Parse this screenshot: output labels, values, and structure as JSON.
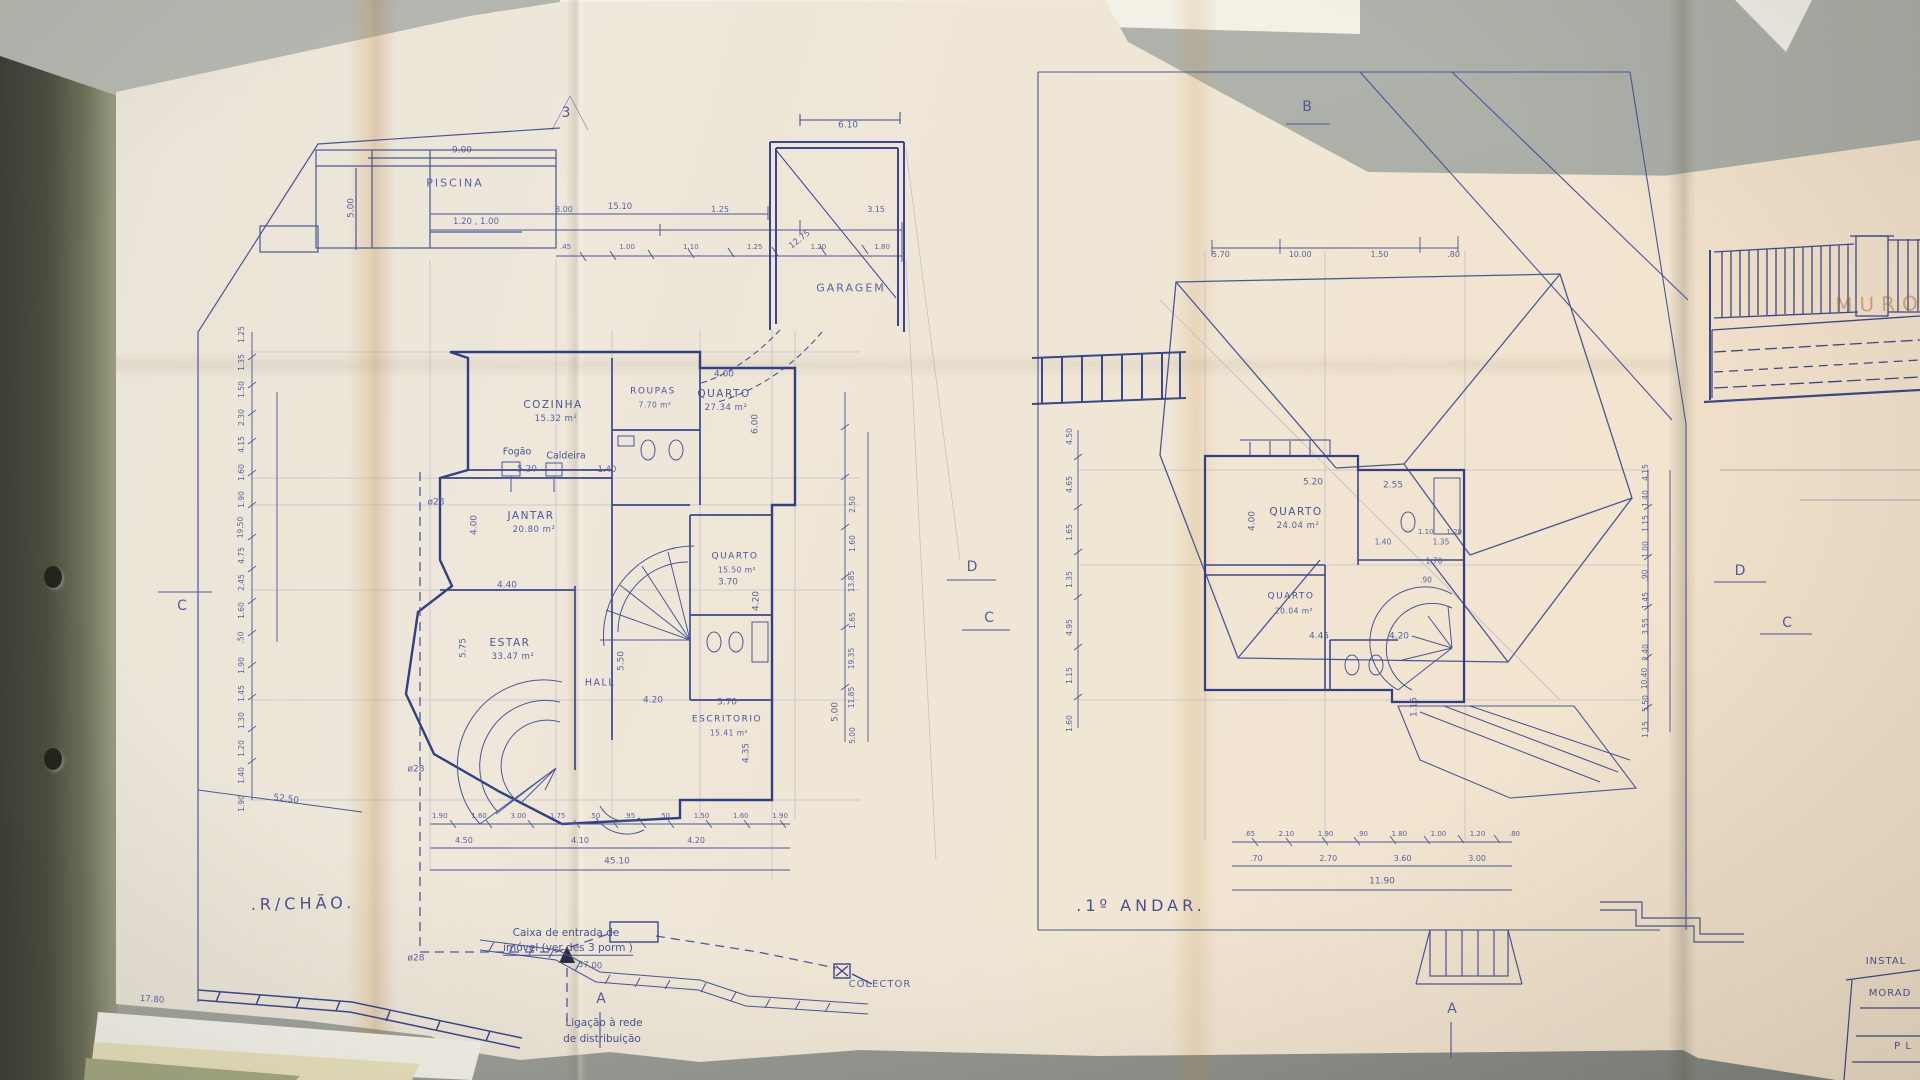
{
  "scene": {
    "desk_color": "#aeb1a9",
    "paper_color": "#ede6d8",
    "ink_color": "#4a5795",
    "stain_color": "#cf9a55"
  },
  "markers": {
    "sheet_number": "3",
    "section_a": "A",
    "section_b": "B",
    "section_c": "C",
    "section_d": "D"
  },
  "left_plan": {
    "title": ".R/CHÃO.",
    "pool": {
      "label": "PISCINA",
      "dim_top": "9.00",
      "dim_side": "5.00",
      "dims_inner": "1.20 , 1.00"
    },
    "garage": {
      "label": "GARAGEM",
      "dim_top": "6.10",
      "dim_diag": "12.75"
    },
    "dim_chain": {
      "total": "15.10",
      "row1": [
        "8.00",
        "1.25",
        "3.15"
      ],
      "row2": [
        ".45",
        "1.00",
        "1.10",
        "1.25",
        "1.20",
        "1.80"
      ]
    },
    "rooms": [
      {
        "name": "COZINHA",
        "area": "15.32 m²"
      },
      {
        "name": "ROUPAS",
        "area": "7.70 m²"
      },
      {
        "name": "QUARTO",
        "area": "27.34 m²"
      },
      {
        "name": "JANTAR",
        "area": "20.80 m²"
      },
      {
        "name": "ESTAR",
        "area": "33.47 m²"
      },
      {
        "name": "HALL",
        "area": ""
      },
      {
        "name": "QUARTO",
        "area": "15.50 m²"
      },
      {
        "name": "ESCRITORIO",
        "area": "15.41 m²"
      }
    ],
    "equipment": {
      "stove": "Fogão",
      "boiler": "Caldeira"
    },
    "pipe_label": "ø28",
    "room_dims": {
      "quarto1_w": "4.00",
      "quarto1_h": "6.00",
      "jantar_w": "5.20",
      "jantar_small": "1.40",
      "jantar_h": "4.00",
      "jantar_b": "4.40",
      "estar_h": "5.75",
      "hall_h": "5.50",
      "hall_w": "4.20",
      "quarto2_w": "3.70",
      "quarto2_h": "4.20",
      "escr_w": "3.70",
      "escr_h": "4.35",
      "escr_r": "5.00"
    },
    "right_col_dims": [
      "2.50",
      "1.60",
      "13.85",
      "1.65",
      "19.35",
      "11.85",
      "5.00"
    ],
    "left_col_dims": [
      "1.25",
      "1.35",
      "1.50",
      "2.30",
      "4.15",
      "1.60",
      "1.90",
      "19.50",
      "4.75",
      "2.45",
      "1.60",
      ".50",
      "1.90",
      "1.45",
      "1.30",
      "1.20",
      "1.40",
      "1.90"
    ],
    "bottom_row1": [
      "1.90",
      "1.60",
      "3.00",
      "1.75",
      ".50",
      ".95",
      ".50",
      "1.50",
      "1.60",
      "1.90"
    ],
    "bottom_row2": [
      "4.50",
      "4.10",
      "4.20"
    ],
    "bottom_total": "45.10",
    "diag_total": "52.50",
    "wall_total": "17.80",
    "entry_note_1": "Caixa de entrada de",
    "entry_note_2": "imóvel (ver des 3 porm )",
    "entry_dim": "57.00",
    "service_note_1": "Ligação à rede",
    "service_note_2": "de distribuição",
    "collector": "COLECTOR"
  },
  "right_plan": {
    "title": ".1º ANDAR.",
    "top_dims": [
      "5.70",
      "10.00",
      "1.50",
      ".80"
    ],
    "left_col_dims": [
      "4.50",
      "4.65",
      "1.65",
      "1.35",
      "4.95",
      "1.15",
      "1.60"
    ],
    "rooms": [
      {
        "name": "QUARTO",
        "area": "24.04 m²"
      },
      {
        "name": "QUARTO",
        "area": "20.04 m²"
      }
    ],
    "room_dims": {
      "w1": "5.20",
      "w2": "2.55",
      "h1": "4.00",
      "s1": "1.40",
      "s2": "1.35",
      "b1": "4.45",
      "b2": "4.20",
      "v1": "1.15"
    },
    "stair_dims": [
      "1.10",
      "1.20"
    ],
    "stair_dim2": "1.70",
    "stair_dim3": ".90",
    "bottom_row1": [
      ".65",
      "2.10",
      "1.90",
      ".90",
      "1.80",
      "1.00",
      "1.20",
      ".80"
    ],
    "bottom_row2": [
      ".70",
      "2.70",
      "3.60",
      "3.00"
    ],
    "bottom_total": "11.90",
    "right_col_dims": [
      "4.15",
      "1.40",
      "1.15",
      "1.00",
      ".90",
      "1.45",
      "3.55",
      "2.40",
      "10.40",
      "5.50",
      "1.15"
    ]
  },
  "side_sheet": {
    "wall_label": "MURO",
    "title_block": [
      "INSTAL",
      "MORAD",
      "P L"
    ]
  }
}
